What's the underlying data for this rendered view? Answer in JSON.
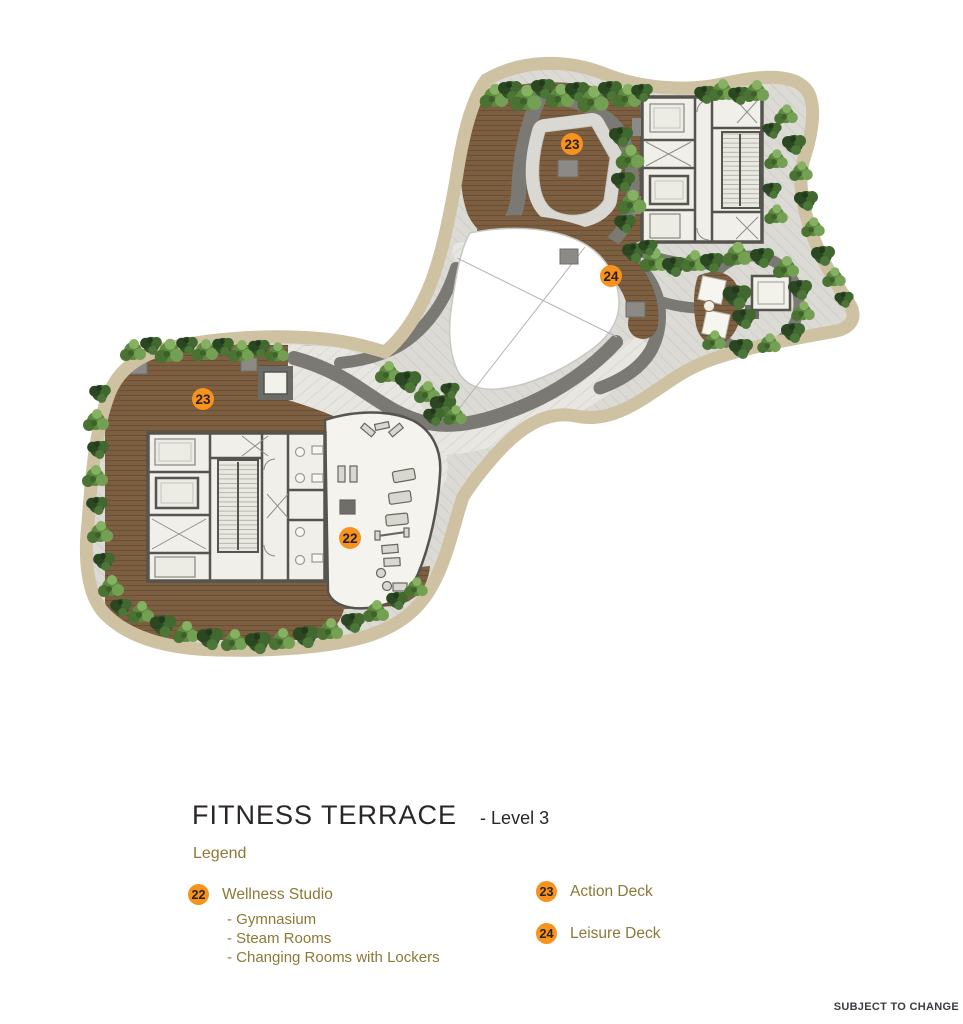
{
  "title": {
    "main": "FITNESS TERRACE",
    "level": "- Level 3"
  },
  "legend": {
    "heading": "Legend",
    "columns": [
      {
        "items": [
          {
            "badge": "22",
            "label": "Wellness Studio",
            "sub_items": [
              "- Gymnasium",
              "- Steam Rooms",
              "- Changing Rooms with Lockers"
            ]
          }
        ]
      },
      {
        "items": [
          {
            "badge": "23",
            "label": "Action Deck",
            "sub_items": []
          },
          {
            "badge": "24",
            "label": "Leisure Deck",
            "sub_items": []
          }
        ]
      }
    ]
  },
  "plan": {
    "markers": [
      {
        "badge": "23",
        "x": 572,
        "y": 144
      },
      {
        "badge": "24",
        "x": 611,
        "y": 276
      },
      {
        "badge": "23",
        "x": 203,
        "y": 399
      },
      {
        "badge": "22",
        "x": 350,
        "y": 538
      }
    ]
  },
  "footer": {
    "disclaimer": "SUBJECT TO CHANGE"
  },
  "colors": {
    "badge_orange": "#F6921E",
    "legend_text": "#8D7837",
    "title_text": "#2A2526",
    "footer_text": "#3B3B43",
    "deck_brown": "#7C5E41",
    "path_dark": "#7B7974",
    "paving_light": "#DBDAD5",
    "tan_border": "#CFC2A3",
    "plant_green": "#4F7A38",
    "building_wall": "#55544F",
    "building_floor": "#F0EFE9"
  }
}
